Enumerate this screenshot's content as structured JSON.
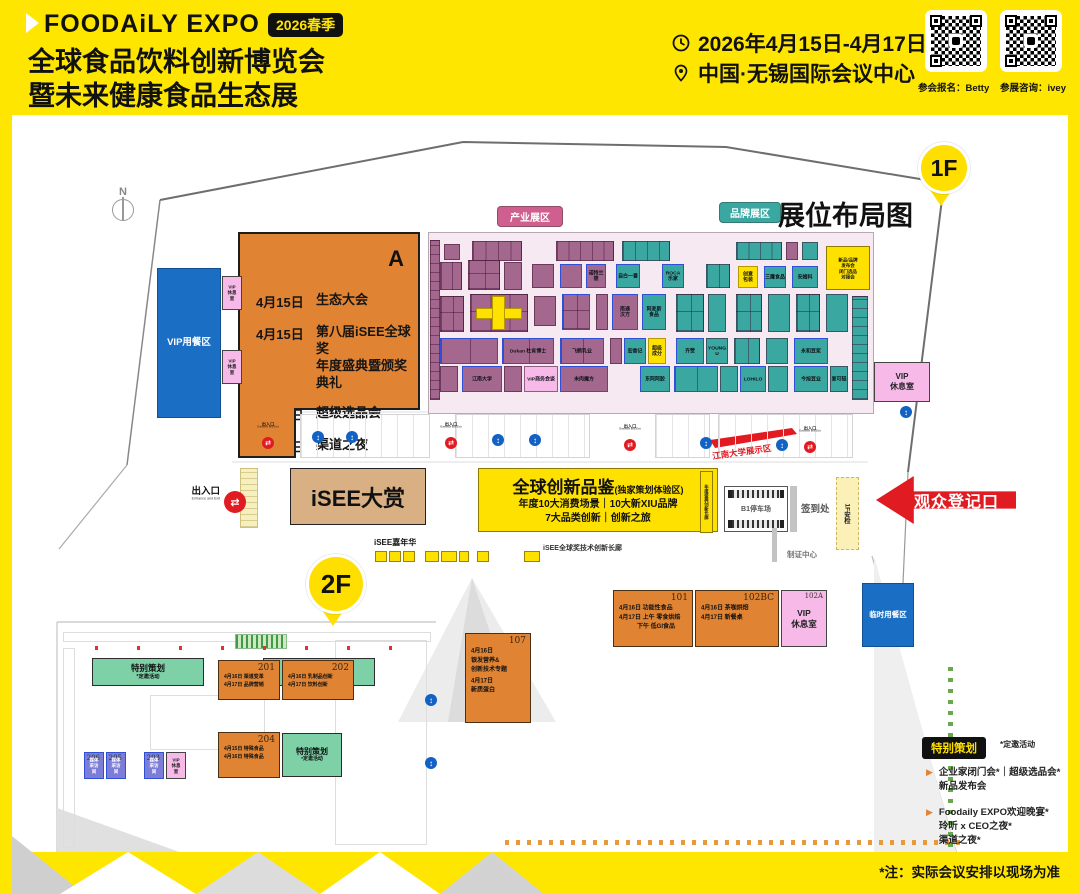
{
  "header": {
    "brand": "FOODAiLY EXPO",
    "season": "2026春季",
    "title1": "全球食品饮料创新博览会",
    "title2": "暨未来健康食品生态展",
    "date": "2026年4月15日-4月17日",
    "venue": "中国·无锡国际会议中心",
    "qr1_label": "参会报名：Betty",
    "qr2_label": "参展咨询：ivey"
  },
  "map": {
    "pin1": "1F",
    "pin2": "2F",
    "title": "展位布局图",
    "compass": "N",
    "badge_industry": "产业展区",
    "badge_brand": "品牌展区",
    "entrance": "出入口",
    "entrance_en": "Entrance and Exit",
    "audience_entry": "观众登记口",
    "security": "1F安检",
    "signin": "签到处",
    "badge_center": "制证中心",
    "parking": "B1停车场",
    "jiangnan": "江南大学展示区",
    "carnival": "iSEE嘉年华",
    "corridor_label": "iSEE全球奖技术创新长廊",
    "award_hall": "iSEE大赏",
    "strip_vert": "年度盛典创新长廊",
    "innovation": {
      "title": "全球创新品鉴",
      "title_sub": "(独家策划体验区)",
      "line1": "年度10大消费场景｜10大新XIU品牌",
      "line2": "7大品类创新｜创新之旅"
    }
  },
  "hallA": {
    "name": "A",
    "schedule": [
      {
        "d": "4月15日",
        "e": "生态大会"
      },
      {
        "d": "4月15日",
        "e": "第八届iSEE全球奖",
        "e2": "年度盛典暨颁奖典礼"
      },
      {
        "d": "4月16日",
        "e": "超级选品会"
      },
      {
        "d": "4月16日",
        "e": "渠道之夜"
      }
    ]
  },
  "rooms": [
    {
      "x": 157,
      "y": 268,
      "w": 64,
      "h": 150,
      "c": "blue",
      "fs": 9.5,
      "lines": [
        "VIP用餐区"
      ]
    },
    {
      "x": 222,
      "y": 276,
      "w": 20,
      "h": 34,
      "c": "pink",
      "fs": 4.5,
      "lines": [
        "VIP",
        "休息室"
      ]
    },
    {
      "x": 222,
      "y": 350,
      "w": 20,
      "h": 34,
      "c": "pink",
      "fs": 4.5,
      "lines": [
        "VIP",
        "休息室"
      ]
    },
    {
      "x": 874,
      "y": 362,
      "w": 56,
      "h": 40,
      "c": "pink",
      "fs": 8,
      "lines": [
        "VIP",
        "休息室"
      ]
    },
    {
      "x": 826,
      "y": 246,
      "w": 44,
      "h": 44,
      "c": "yellow",
      "fs": 4.5,
      "lines": [
        "新品/品牌发布会",
        "闭门选品对接会"
      ]
    },
    {
      "x": 862,
      "y": 583,
      "w": 52,
      "h": 64,
      "c": "blue",
      "fs": 7.5,
      "lines": [
        "临时用餐区"
      ]
    },
    {
      "x": 92,
      "y": 658,
      "w": 112,
      "h": 28,
      "c": "green",
      "fs": 8.5,
      "lines": [
        "特别策划",
        "*定邀活动"
      ]
    },
    {
      "x": 263,
      "y": 658,
      "w": 112,
      "h": 28,
      "c": "green",
      "fs": 8.5,
      "lines": [
        "特别策划",
        "*定邀活动"
      ]
    },
    {
      "x": 282,
      "y": 733,
      "w": 60,
      "h": 44,
      "c": "green",
      "fs": 8,
      "lines": [
        "特别策划",
        "*定邀活动"
      ]
    },
    {
      "x": 84,
      "y": 752,
      "w": 20,
      "h": 27,
      "c": "purple",
      "fs": 4.5,
      "num": "206",
      "lines": [
        "媒体",
        "采访间"
      ]
    },
    {
      "x": 106,
      "y": 752,
      "w": 20,
      "h": 27,
      "c": "purple",
      "fs": 4.5,
      "num": "205",
      "lines": [
        "媒体",
        "采访间"
      ]
    },
    {
      "x": 144,
      "y": 752,
      "w": 20,
      "h": 27,
      "c": "purple",
      "fs": 4.5,
      "num": "203",
      "lines": [
        "媒体",
        "采访间"
      ]
    },
    {
      "x": 166,
      "y": 752,
      "w": 20,
      "h": 27,
      "c": "pink",
      "fs": 4.5,
      "lines": [
        "VIP",
        "休息室"
      ]
    },
    {
      "x": 781,
      "y": 590,
      "w": 46,
      "h": 57,
      "c": "pink",
      "fs": 8.5,
      "num": "102A",
      "lines": [
        "VIP",
        "休息室"
      ]
    }
  ],
  "sessions": [
    {
      "x": 218,
      "y": 660,
      "w": 62,
      "h": 40,
      "num": "201",
      "fs": 5,
      "lines": [
        "4月16日 渠道变革",
        "4月17日 品牌营销"
      ]
    },
    {
      "x": 282,
      "y": 660,
      "w": 72,
      "h": 40,
      "num": "202",
      "fs": 5,
      "lines": [
        "4月16日 乳制品创新",
        "4月17日 饮料创新"
      ]
    },
    {
      "x": 218,
      "y": 732,
      "w": 62,
      "h": 46,
      "num": "204",
      "fs": 5,
      "lines": [
        "4月15日 特殊食品",
        "4月16日 特殊食品"
      ]
    },
    {
      "x": 613,
      "y": 590,
      "w": 80,
      "h": 57,
      "num": "101",
      "fs": 6,
      "lines": [
        "4月16日 功能性食品",
        "4月17日 上午 零食烘焙",
        "　　　下午 低GI食品"
      ]
    },
    {
      "x": 695,
      "y": 590,
      "w": 84,
      "h": 57,
      "num": "102BC",
      "fs": 6,
      "lines": [
        "4月16日 茶咖烘焙",
        "4月17日 新餐桌"
      ]
    },
    {
      "x": 465,
      "y": 633,
      "w": 66,
      "h": 90,
      "num": "107",
      "fs": 6,
      "lines": [
        "4月16日",
        "银发营养&",
        "创新技术专题",
        "",
        "4月17日",
        "新质蛋白"
      ]
    }
  ],
  "booths": [
    [
      430,
      240,
      10,
      160,
      "P",
      "V",
      null,
      0
    ],
    [
      444,
      244,
      16,
      16,
      "P",
      0,
      null,
      0
    ],
    [
      472,
      241,
      50,
      20,
      "P",
      4,
      null,
      0
    ],
    [
      556,
      241,
      58,
      20,
      "P",
      5,
      null,
      0
    ],
    [
      622,
      241,
      48,
      20,
      "T",
      4,
      null,
      0
    ],
    [
      736,
      242,
      46,
      18,
      "T",
      4,
      null,
      0
    ],
    [
      786,
      242,
      12,
      18,
      "P",
      0,
      null,
      0
    ],
    [
      802,
      242,
      16,
      18,
      "T",
      0,
      null,
      0
    ],
    [
      852,
      296,
      16,
      104,
      "T",
      "V",
      null,
      0
    ],
    [
      440,
      262,
      22,
      28,
      "P",
      2,
      null,
      0
    ],
    [
      468,
      260,
      32,
      30,
      "P",
      2,
      null,
      0
    ],
    [
      504,
      262,
      18,
      28,
      "P",
      0,
      null,
      0
    ],
    [
      532,
      264,
      22,
      24,
      "P",
      0,
      null,
      0
    ],
    [
      560,
      264,
      22,
      24,
      "P",
      0,
      null,
      1
    ],
    [
      586,
      264,
      20,
      24,
      "P",
      0,
      "诺特兰德",
      1
    ],
    [
      616,
      264,
      24,
      24,
      "T",
      0,
      "自白一番",
      1
    ],
    [
      662,
      264,
      22,
      24,
      "T",
      0,
      "ROCA\n乐家",
      1
    ],
    [
      706,
      264,
      24,
      24,
      "T",
      2,
      null,
      0
    ],
    [
      738,
      266,
      20,
      22,
      "Y",
      0,
      "创意\n包装",
      0
    ],
    [
      764,
      266,
      22,
      22,
      "T",
      0,
      "三鹰食品",
      1
    ],
    [
      792,
      266,
      26,
      22,
      "T",
      0,
      "安姆科",
      1
    ],
    [
      440,
      296,
      24,
      36,
      "P",
      2,
      null,
      0
    ],
    [
      470,
      294,
      58,
      38,
      "P",
      3,
      null,
      0
    ],
    [
      476,
      308,
      46,
      11,
      "Y",
      0,
      null,
      0
    ],
    [
      492,
      296,
      13,
      34,
      "Y",
      0,
      null,
      0
    ],
    [
      534,
      296,
      22,
      30,
      "P",
      0,
      null,
      0
    ],
    [
      562,
      294,
      28,
      36,
      "P",
      2,
      null,
      1
    ],
    [
      596,
      294,
      12,
      36,
      "P",
      0,
      null,
      0
    ],
    [
      612,
      294,
      26,
      36,
      "P",
      0,
      "南通\n汉方",
      1
    ],
    [
      642,
      294,
      24,
      36,
      "T",
      0,
      "阿麦斯\n食品",
      1
    ],
    [
      676,
      294,
      28,
      38,
      "T",
      2,
      null,
      0
    ],
    [
      708,
      294,
      18,
      38,
      "T",
      0,
      null,
      0
    ],
    [
      736,
      294,
      26,
      38,
      "T",
      2,
      null,
      0
    ],
    [
      768,
      294,
      22,
      38,
      "T",
      0,
      null,
      0
    ],
    [
      796,
      294,
      24,
      38,
      "T",
      2,
      null,
      0
    ],
    [
      826,
      294,
      22,
      38,
      "T",
      0,
      null,
      0
    ],
    [
      440,
      338,
      58,
      26,
      "P",
      2,
      null,
      1
    ],
    [
      502,
      338,
      52,
      26,
      "P",
      2,
      "Dukan 杜肯博士",
      1
    ],
    [
      560,
      338,
      44,
      26,
      "P",
      2,
      "飞鹤乳业",
      1
    ],
    [
      610,
      338,
      12,
      26,
      "P",
      0,
      null,
      0
    ],
    [
      624,
      338,
      22,
      26,
      "T",
      0,
      "宏香记",
      1
    ],
    [
      648,
      338,
      18,
      26,
      "Y",
      0,
      "超级\n成分",
      0
    ],
    [
      676,
      338,
      28,
      26,
      "T",
      0,
      "齐赞",
      1
    ],
    [
      706,
      338,
      22,
      26,
      "T",
      0,
      "YOUNG U",
      0
    ],
    [
      734,
      338,
      26,
      26,
      "T",
      2,
      null,
      0
    ],
    [
      766,
      338,
      22,
      26,
      "T",
      0,
      null,
      0
    ],
    [
      794,
      338,
      34,
      26,
      "T",
      0,
      "永和豆浆",
      1
    ],
    [
      440,
      366,
      18,
      26,
      "P",
      0,
      null,
      0
    ],
    [
      462,
      366,
      40,
      26,
      "P",
      0,
      "江南大学",
      1
    ],
    [
      504,
      366,
      18,
      26,
      "P",
      0,
      null,
      0
    ],
    [
      524,
      366,
      34,
      26,
      "K",
      0,
      "VIP商务会谈",
      0
    ],
    [
      560,
      366,
      48,
      26,
      "P",
      0,
      "未肉魔方",
      1
    ],
    [
      640,
      366,
      30,
      26,
      "T",
      0,
      "东阿阿胶",
      1
    ],
    [
      674,
      366,
      44,
      26,
      "T",
      2,
      null,
      1
    ],
    [
      720,
      366,
      18,
      26,
      "T",
      0,
      null,
      0
    ],
    [
      740,
      366,
      26,
      26,
      "T",
      0,
      "LOHILO",
      1
    ],
    [
      768,
      366,
      20,
      26,
      "T",
      0,
      null,
      0
    ],
    [
      794,
      366,
      34,
      26,
      "T",
      0,
      "今旭豆业",
      1
    ],
    [
      830,
      366,
      18,
      26,
      "T",
      0,
      "复可轻",
      0
    ]
  ],
  "markers": {
    "red": [
      [
        268,
        437
      ],
      [
        451,
        437
      ],
      [
        630,
        439
      ],
      [
        810,
        441
      ]
    ],
    "blue": [
      [
        318,
        431
      ],
      [
        352,
        431
      ],
      [
        498,
        434
      ],
      [
        535,
        434
      ],
      [
        706,
        437
      ],
      [
        782,
        439
      ],
      [
        906,
        406
      ],
      [
        431,
        694
      ],
      [
        431,
        757
      ]
    ]
  },
  "mini_boxes": [
    [
      375,
      12
    ],
    [
      389,
      12
    ],
    [
      403,
      12
    ],
    [
      425,
      14
    ],
    [
      441,
      16
    ],
    [
      459,
      10
    ],
    [
      477,
      12
    ],
    [
      524,
      16
    ]
  ],
  "special": {
    "badge": "特别策划",
    "side": "*定邀活动",
    "bullets": [
      [
        "企业家闭门会*｜超级选品会*",
        "新品发布会"
      ],
      [
        "Foodaily EXPO欢迎晚宴*",
        "玲听 x CEO之夜*",
        "渠道之夜*"
      ]
    ],
    "footnote": "*注：实际会议安排以现场为准"
  }
}
